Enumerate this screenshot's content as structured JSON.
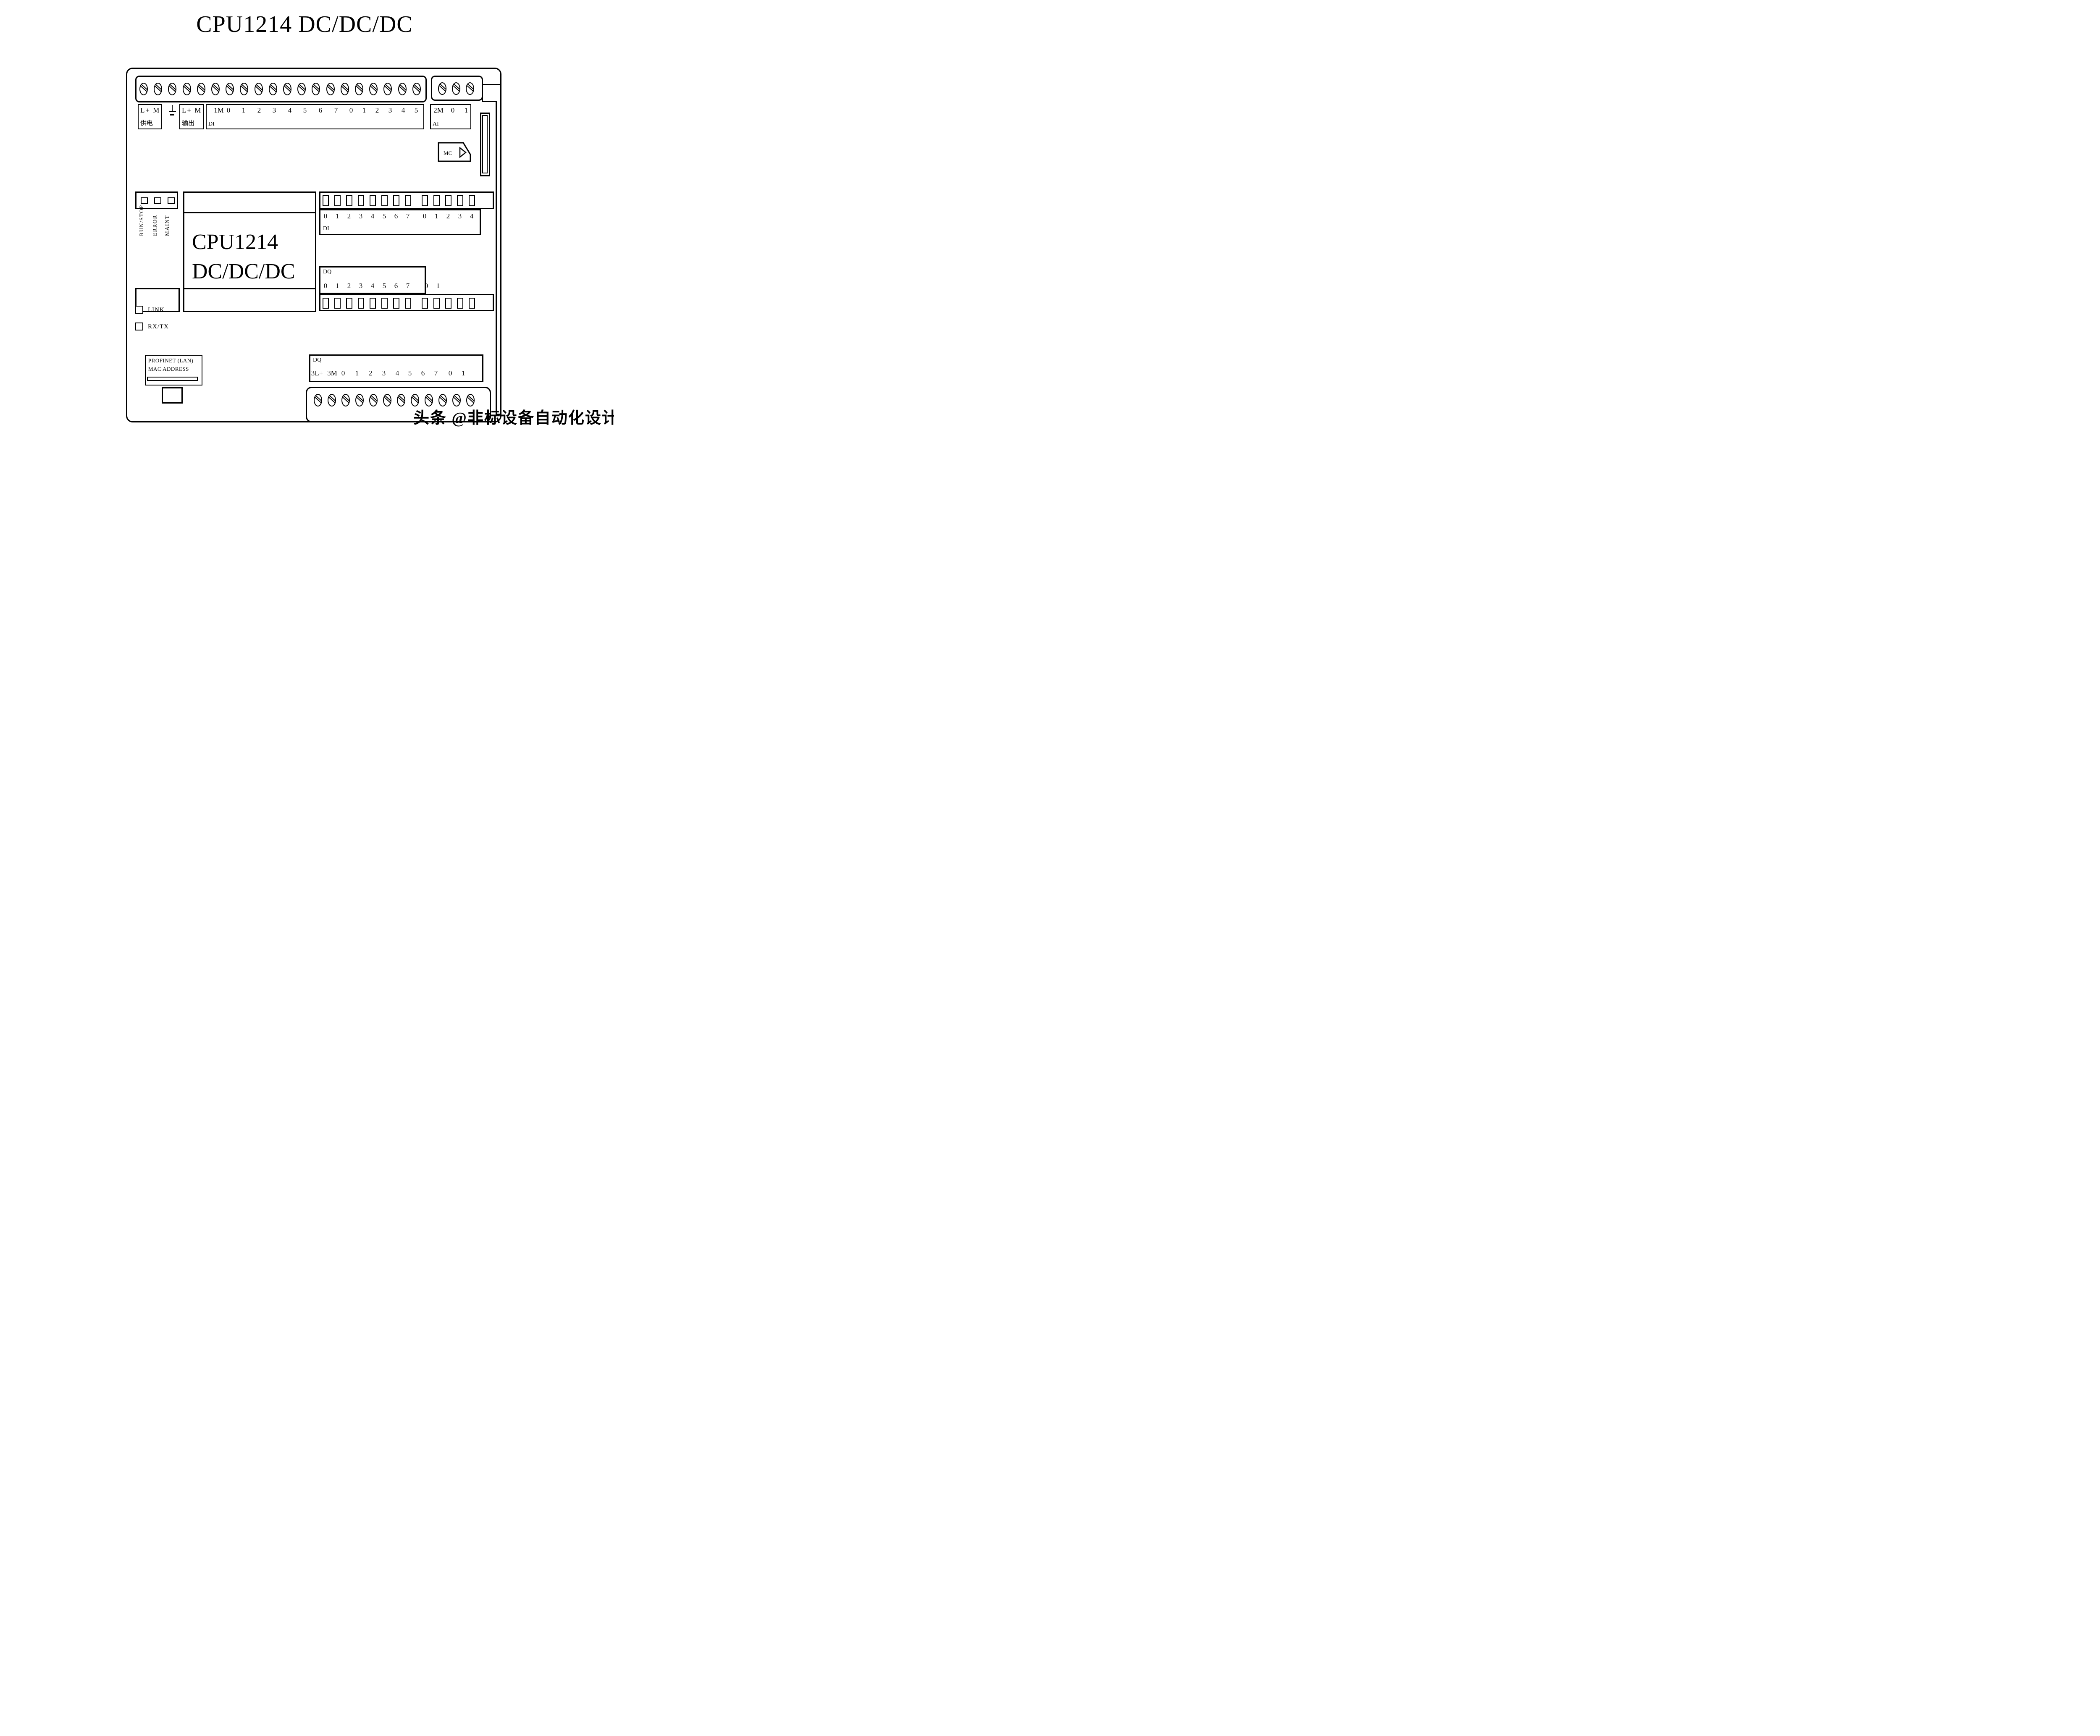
{
  "title": "CPU1214 DC/DC/DC",
  "device": {
    "model_line1": "CPU1214",
    "model_line2": "DC/DC/DC"
  },
  "power": {
    "terminals": "L+ M",
    "label": "供电"
  },
  "earth": {
    "icon": "functional-earth-icon"
  },
  "sensor_output": {
    "terminals": "L+ M",
    "label": "输出"
  },
  "di_terminals": {
    "group_label": "DI",
    "labels": [
      "1M",
      "0",
      "1",
      "2",
      "3",
      "4",
      "5",
      "6",
      "7",
      "0",
      "1",
      "2",
      "3",
      "4",
      "5"
    ]
  },
  "ai_terminals": {
    "group_label": "AI",
    "labels": [
      "2M",
      "0",
      "1"
    ]
  },
  "memory_card": {
    "label": "MC",
    "icon": "memory-card-icon"
  },
  "status_leds": {
    "led_count": 3,
    "leds": [
      {
        "label": "RUN/STOP"
      },
      {
        "label": "ERROR"
      },
      {
        "label": "MAINT"
      }
    ]
  },
  "di_indicator": {
    "group_label": "DI",
    "led_count": 13,
    "labels": [
      "0",
      "1",
      "2",
      "3",
      "4",
      "5",
      "6",
      "7",
      "0",
      "1",
      "2",
      "3",
      "4"
    ]
  },
  "dq_indicator": {
    "group_label": "DQ",
    "led_count": 13,
    "labels": [
      "0",
      "1",
      "2",
      "3",
      "4",
      "5",
      "6",
      "7",
      "0",
      "1"
    ]
  },
  "ethernet_leds": [
    {
      "label": "LINK"
    },
    {
      "label": "RX/TX"
    }
  ],
  "profinet": {
    "line1": "PROFINET (LAN)",
    "line2": "MAC ADDRESS"
  },
  "dq_terminals": {
    "group_label": "DQ",
    "labels": [
      "3L+",
      "3M",
      "0",
      "1",
      "2",
      "3",
      "4",
      "5",
      "6",
      "7",
      "0",
      "1"
    ]
  },
  "screws": {
    "top_main_count": 20,
    "top_ai_count": 3,
    "bottom_count": 12
  },
  "watermark": "头条 @非标设备自动化设计",
  "colors": {
    "line": "#000000",
    "background": "#ffffff"
  }
}
